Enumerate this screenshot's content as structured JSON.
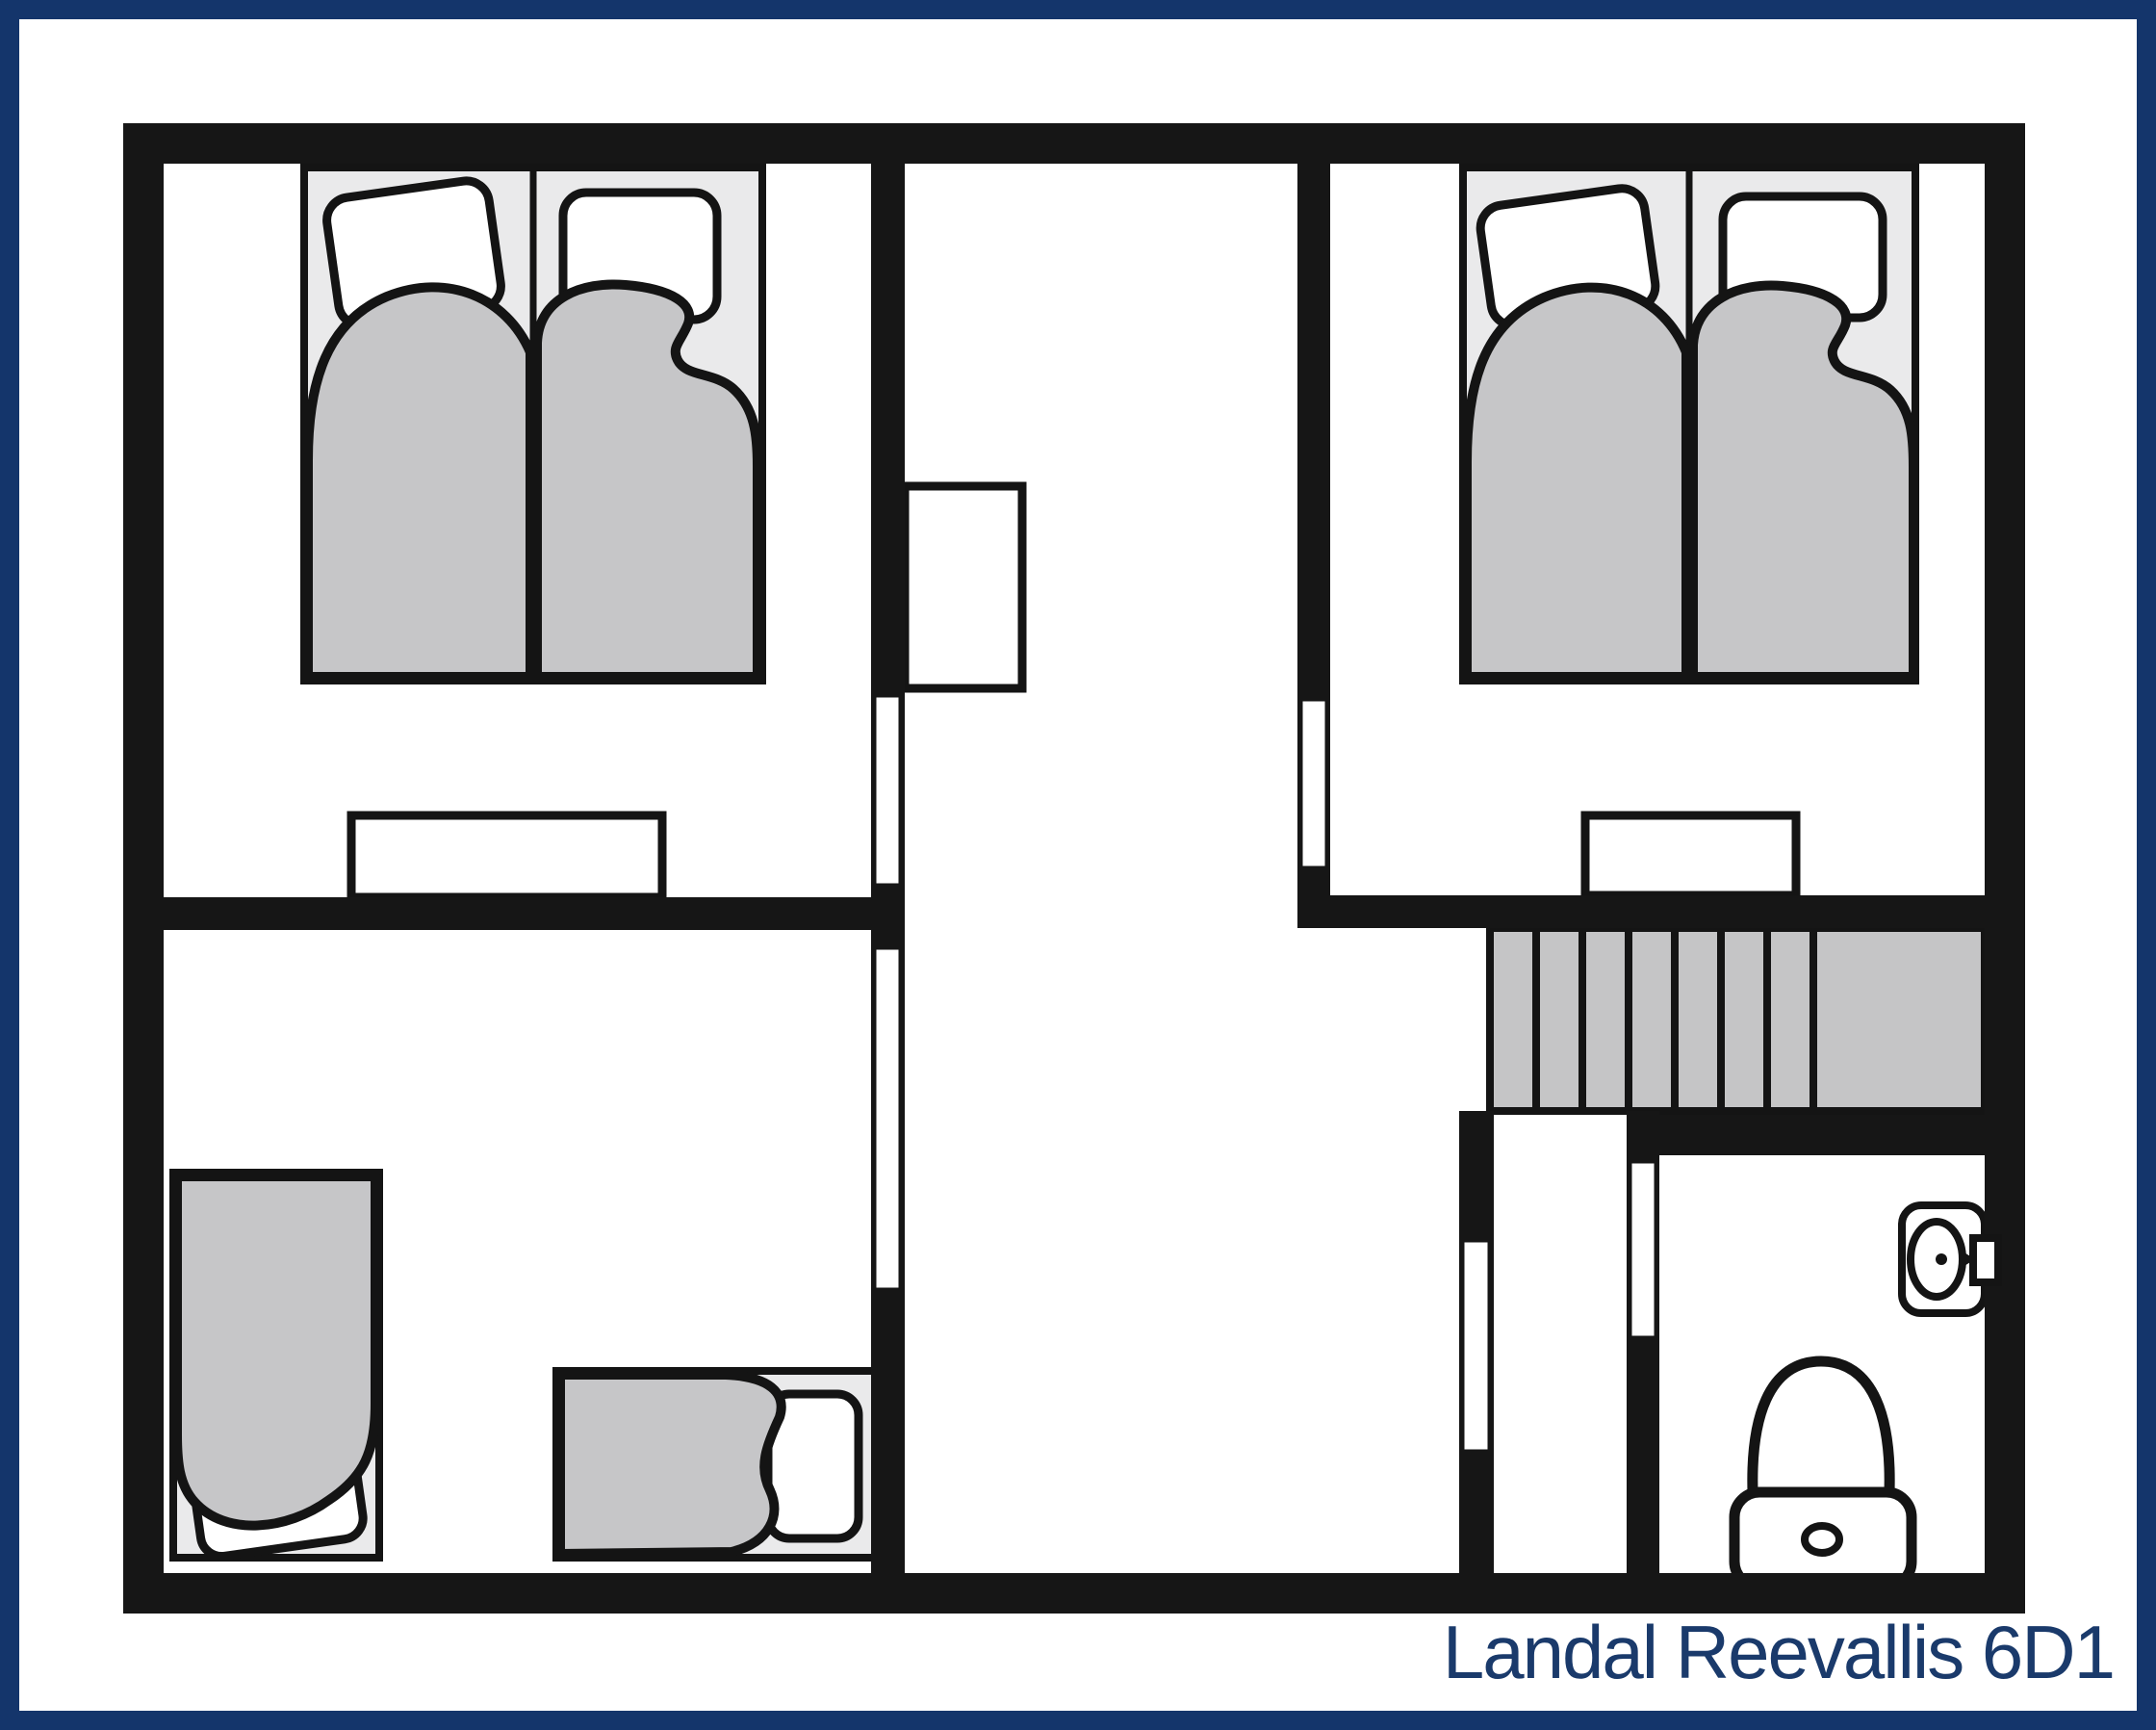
{
  "title": "Landal Reevallis 6D1",
  "colors": {
    "border_navy": "#14356b",
    "title_navy": "#1a3a6b",
    "wall_black": "#161616",
    "duvet_gray": "#c6c6c8",
    "bedframe_gray": "#eaeaeb",
    "stairs_gray": "#c5c5c6",
    "background": "#ffffff"
  },
  "floorplan": {
    "areas": {
      "bedroom_top_left": {
        "items": [
          "double bed of two singles",
          "tilted pillow",
          "straight pillow",
          "dresser against wall"
        ]
      },
      "bedroom_top_right": {
        "items": [
          "double bed of two singles",
          "tilted pillow",
          "straight pillow",
          "dresser against wall"
        ]
      },
      "bedroom_bottom_left": {
        "items": [
          "single bed vertical",
          "single bed horizontal"
        ]
      },
      "hallway": {
        "items": [
          "wardrobe cupboard"
        ]
      },
      "stairs": {
        "treads": 7,
        "landing": true
      },
      "under_stairs_store": {
        "items": []
      },
      "bathroom": {
        "items": [
          "toilet",
          "wash basin with tap"
        ]
      }
    },
    "door_openings": 5
  }
}
